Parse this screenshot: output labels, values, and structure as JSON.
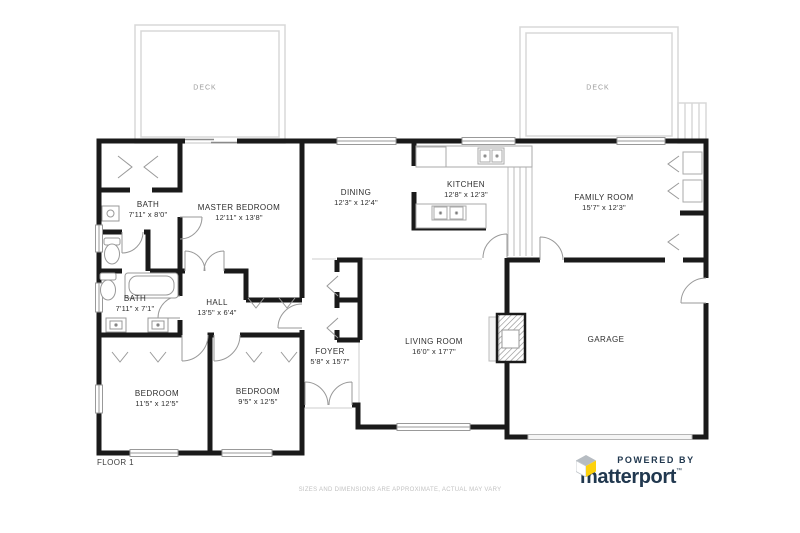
{
  "plan": {
    "floor_label": "FLOOR 1",
    "disclaimer": "SIZES AND DIMENSIONS ARE APPROXIMATE, ACTUAL MAY VARY",
    "rooms": [
      {
        "name": "DECK",
        "dims": ""
      },
      {
        "name": "DECK",
        "dims": ""
      },
      {
        "name": "BATH",
        "dims": "7'11\" x 8'0\""
      },
      {
        "name": "MASTER BEDROOM",
        "dims": "12'11\" x 13'8\""
      },
      {
        "name": "DINING",
        "dims": "12'3\" x 12'4\""
      },
      {
        "name": "KITCHEN",
        "dims": "12'8\" x 12'3\""
      },
      {
        "name": "FAMILY ROOM",
        "dims": "15'7\" x 12'3\""
      },
      {
        "name": "BATH",
        "dims": "7'11\" x 7'1\""
      },
      {
        "name": "HALL",
        "dims": "13'5\" x 6'4\""
      },
      {
        "name": "FOYER",
        "dims": "5'8\" x 15'7\""
      },
      {
        "name": "LIVING ROOM",
        "dims": "16'0\" x 17'7\""
      },
      {
        "name": "GARAGE",
        "dims": ""
      },
      {
        "name": "BEDROOM",
        "dims": "11'5\" x 12'5\""
      },
      {
        "name": "BEDROOM",
        "dims": "9'5\" x 12'5\""
      }
    ]
  },
  "branding": {
    "powered_by": "POWERED BY",
    "brand": "matterport",
    "brand_mark": "™"
  },
  "colors": {
    "wall": "#1a1a1a",
    "brand_navy": "#21384f",
    "brand_yellow": "#fdd10c"
  }
}
